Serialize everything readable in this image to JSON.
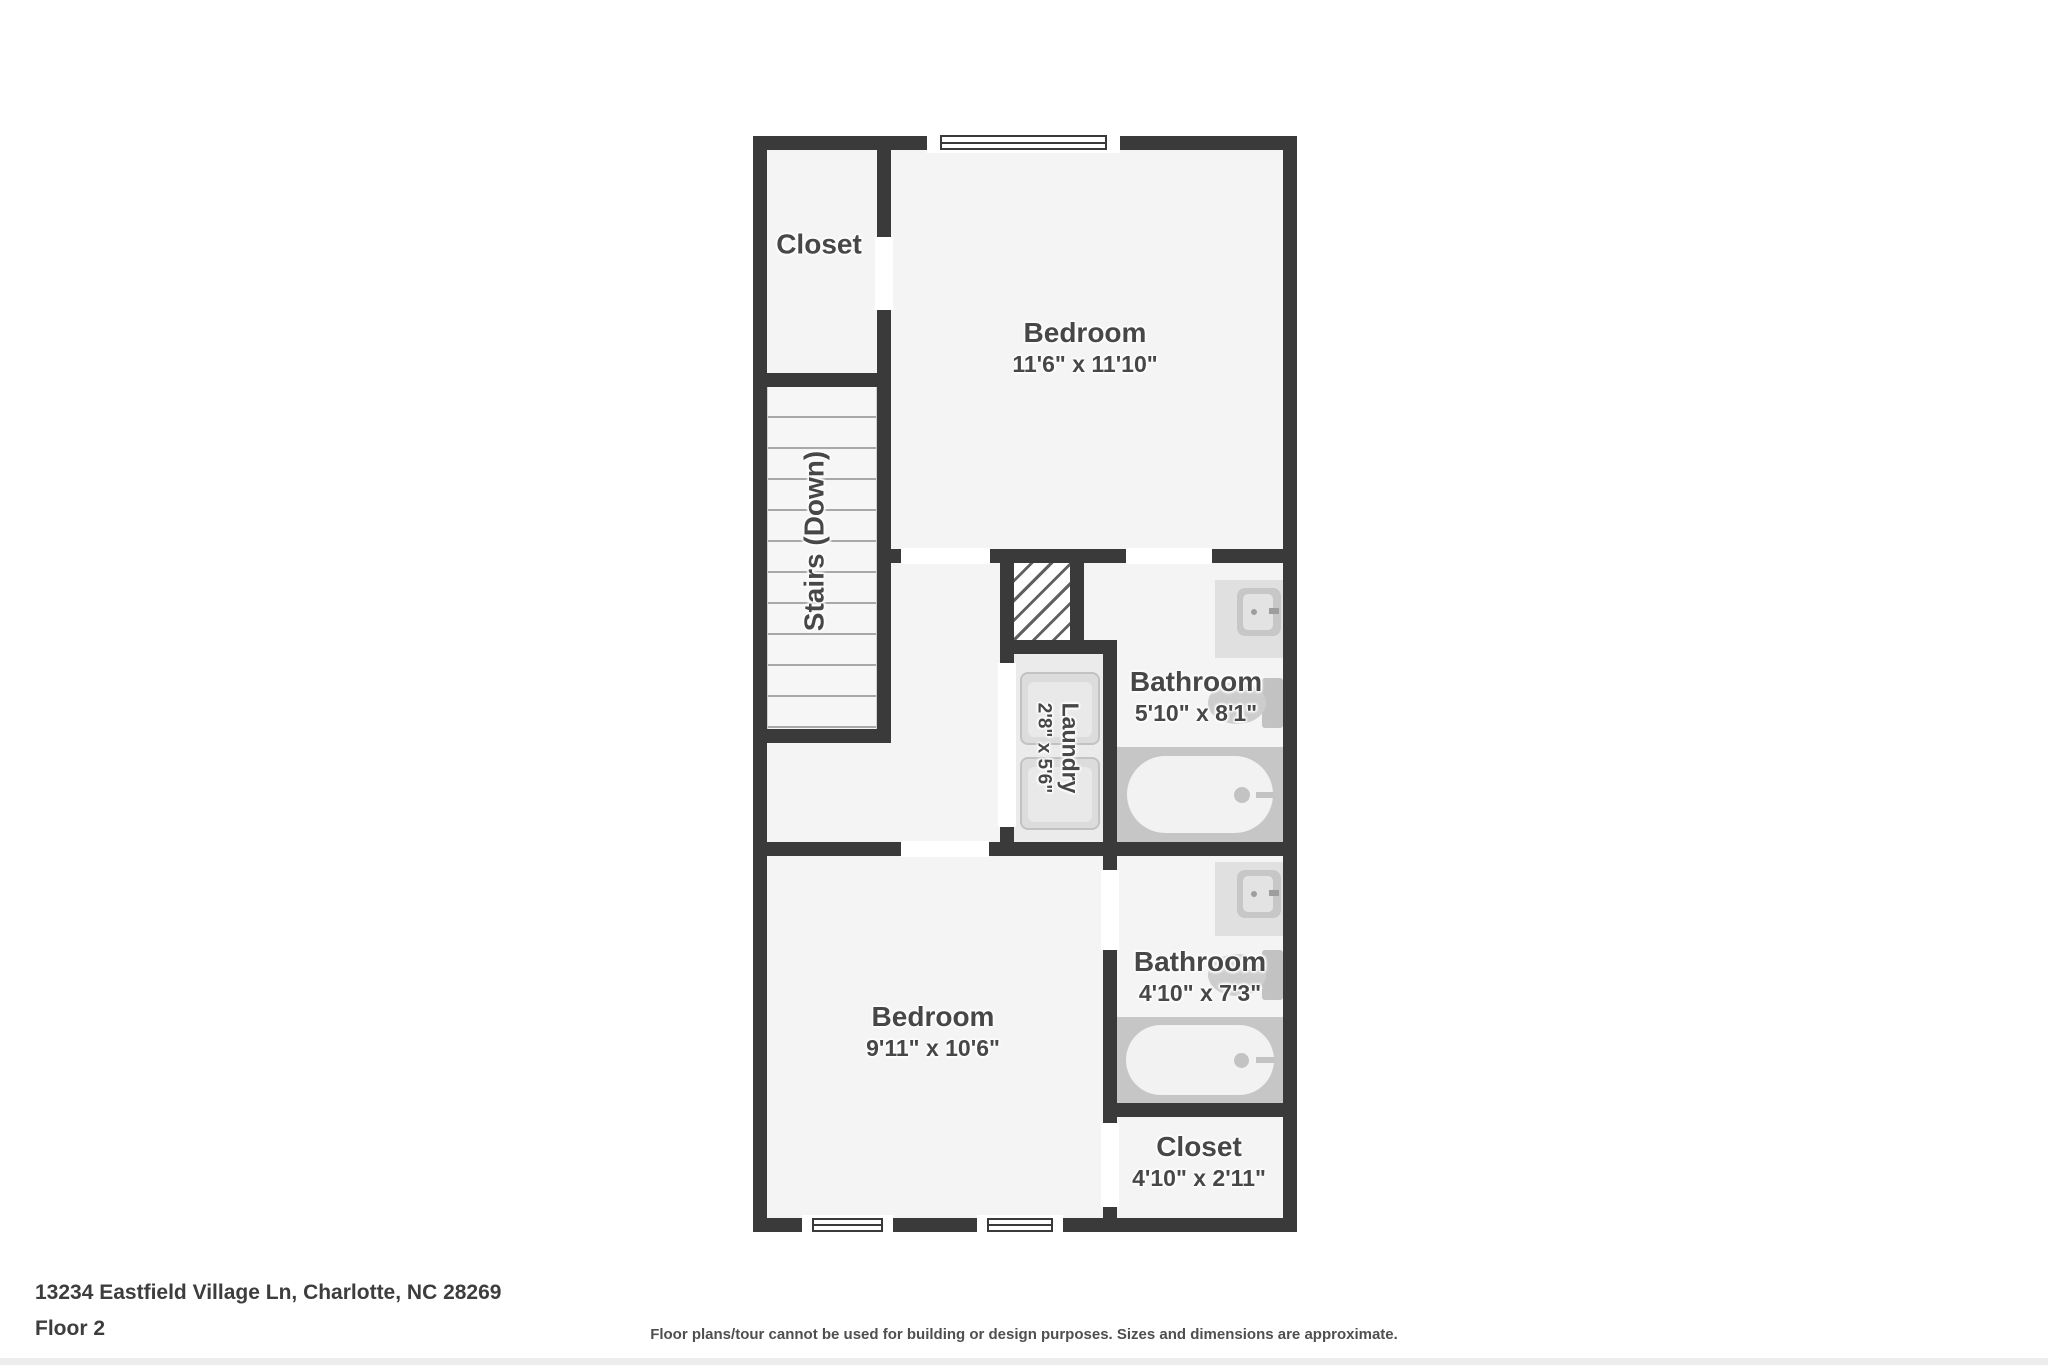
{
  "plan": {
    "rooms": {
      "closet_top": {
        "name": "Closet"
      },
      "bedroom_top": {
        "name": "Bedroom",
        "dims": "11'6\" x 11'10\""
      },
      "stairs": {
        "name": "Stairs (Down)"
      },
      "laundry": {
        "name": "Laundry",
        "dims": "2'8\" x 5'6\""
      },
      "bathroom_top": {
        "name": "Bathroom",
        "dims": "5'10\" x 8'1\""
      },
      "bedroom_bottom": {
        "name": "Bedroom",
        "dims": "9'11\" x 10'6\""
      },
      "bathroom_bottom": {
        "name": "Bathroom",
        "dims": "4'10\" x 7'3\""
      },
      "closet_bottom": {
        "name": "Closet",
        "dims": "4'10\" x 2'11\""
      }
    },
    "colors": {
      "wall": "#3a3a3a",
      "floor": "#f4f4f4",
      "laundry_floor": "#ebebeb",
      "fixture_gray": "#c6c6c6",
      "label_text": "#474747"
    }
  },
  "footer": {
    "address": "13234 Eastfield Village Ln, Charlotte, NC 28269",
    "floor_label": "Floor 2",
    "disclaimer": "Floor plans/tour cannot be used for building or design purposes. Sizes and dimensions are approximate."
  }
}
